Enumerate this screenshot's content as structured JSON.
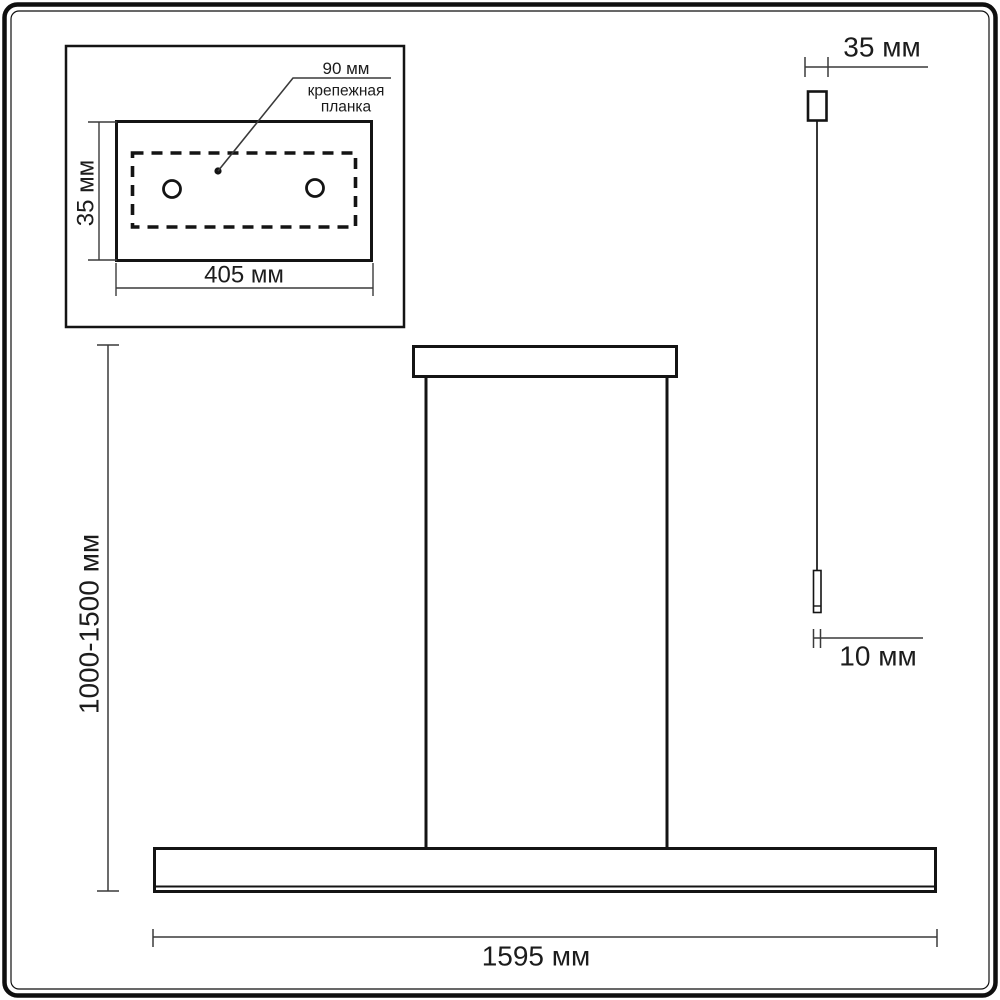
{
  "colors": {
    "line": "#1c1c1c",
    "dimension_line": "#3a3a3a",
    "background": "#ffffff"
  },
  "inset_detail": {
    "hole_spacing_label": "90 мм",
    "plate_label_line1": "крепежная",
    "plate_label_line2": "планка",
    "plate_width_label": "405 мм",
    "plate_height_label": "35 мм"
  },
  "fixture_front": {
    "suspension_height_label": "1000-1500 мм",
    "fixture_length_label": "1595 мм"
  },
  "fixture_side": {
    "canopy_width_label": "35 мм",
    "rod_width_label": "10 мм"
  }
}
